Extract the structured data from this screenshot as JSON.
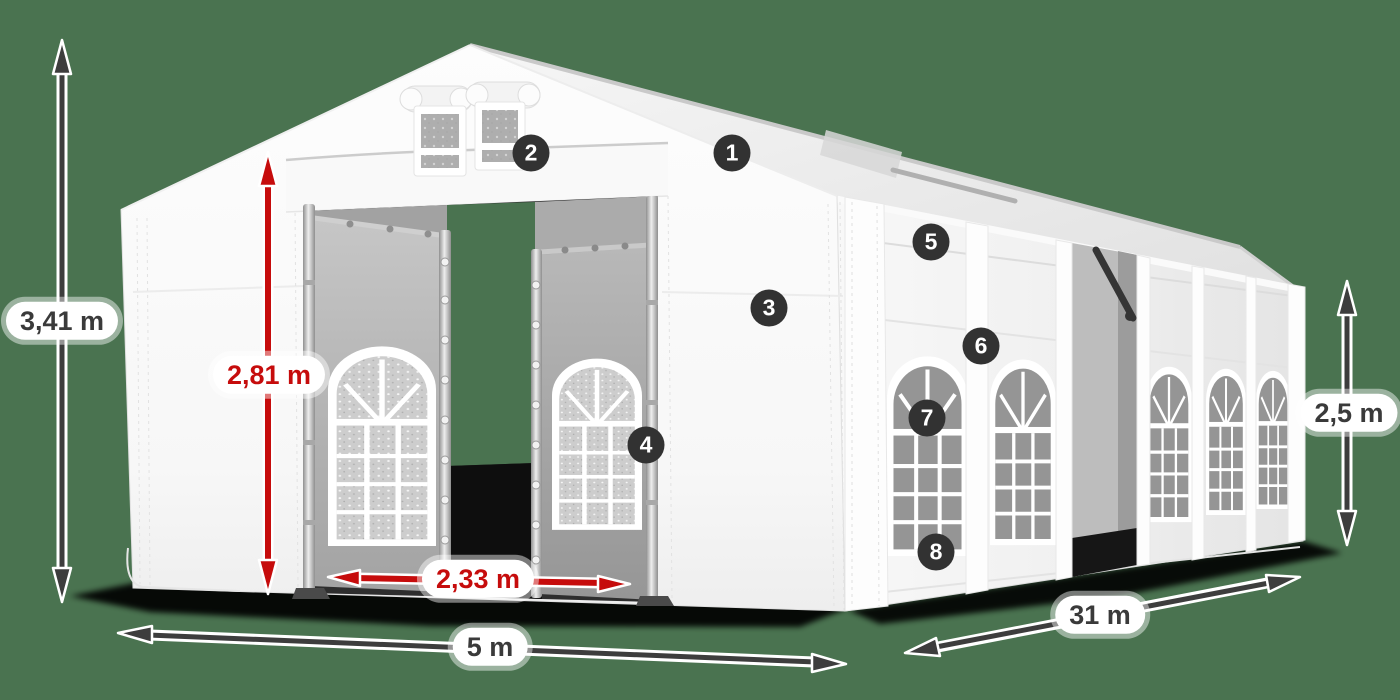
{
  "colors": {
    "background": "#4a7350",
    "arrow_dark": "#3d3d3d",
    "accent_red": "#c60c0c",
    "badge": "#323232",
    "tent_white": "#ffffff"
  },
  "dimensions": {
    "total_height": "3,41 m",
    "entrance_height": "2,81 m",
    "entrance_width": "2,33 m",
    "front_width": "5 m",
    "side_length": "31 m",
    "side_height": "2,5 m"
  },
  "badges": [
    "1",
    "2",
    "3",
    "4",
    "5",
    "6",
    "7",
    "8"
  ]
}
